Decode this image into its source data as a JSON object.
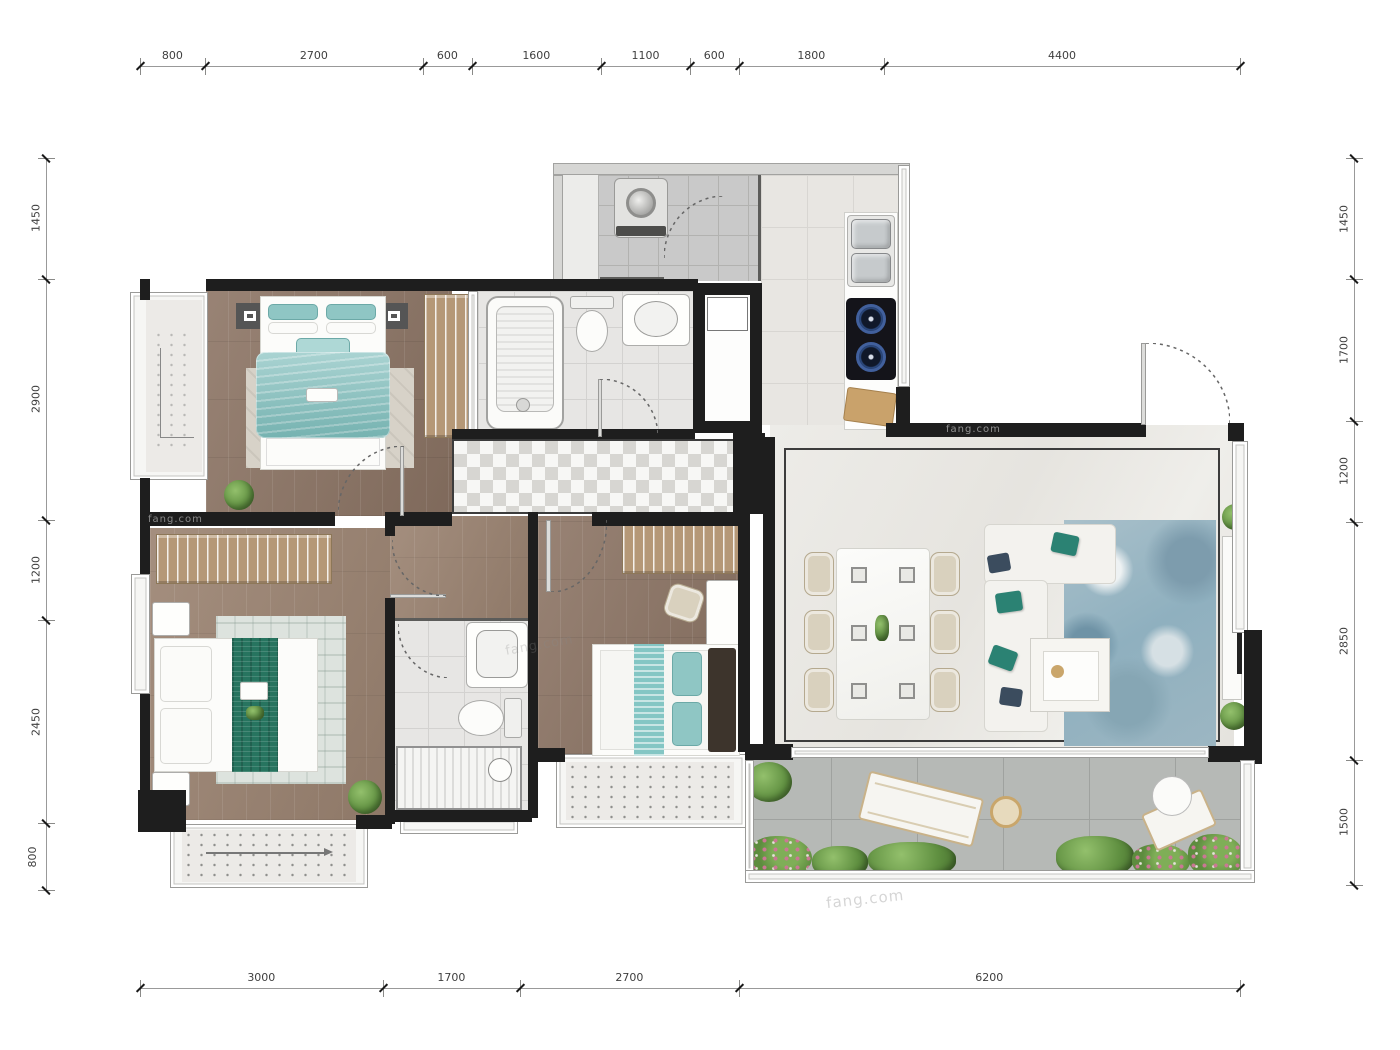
{
  "document": {
    "type": "apartment-floorplan"
  },
  "watermark": "fang.com",
  "dimensions": {
    "top": [
      "800",
      "2700",
      "600",
      "1600",
      "1100",
      "600",
      "1800",
      "4400"
    ],
    "bottom": [
      "3000",
      "1700",
      "2700",
      "6200"
    ],
    "left": [
      "1450",
      "2900",
      "1200",
      "2450",
      "800"
    ],
    "right": [
      "1450",
      "1700",
      "1200",
      "2850",
      "1500"
    ]
  },
  "colors": {
    "wall": "#1e1e1e",
    "wood-a": "#8d7565",
    "wood-b": "#9a8270",
    "tile": "#e7e6e4",
    "gray-tile": "#c9c9c9",
    "marble": "#eceae7",
    "living-floor": "#e9e7e2",
    "balcony-floor": "#b6b9b6",
    "teal-bedding": "#7cbcba",
    "teal-dark": "#27745f",
    "wardrobe-tan": "#b59877",
    "rug-beige": "#d7d2c8",
    "rug-blue": "#9db8c4",
    "chair-beige": "#d9d1be",
    "plant-green": "#5f8f40",
    "flower-pink": "#cb7795",
    "dim-text": "#3f3f3f"
  }
}
